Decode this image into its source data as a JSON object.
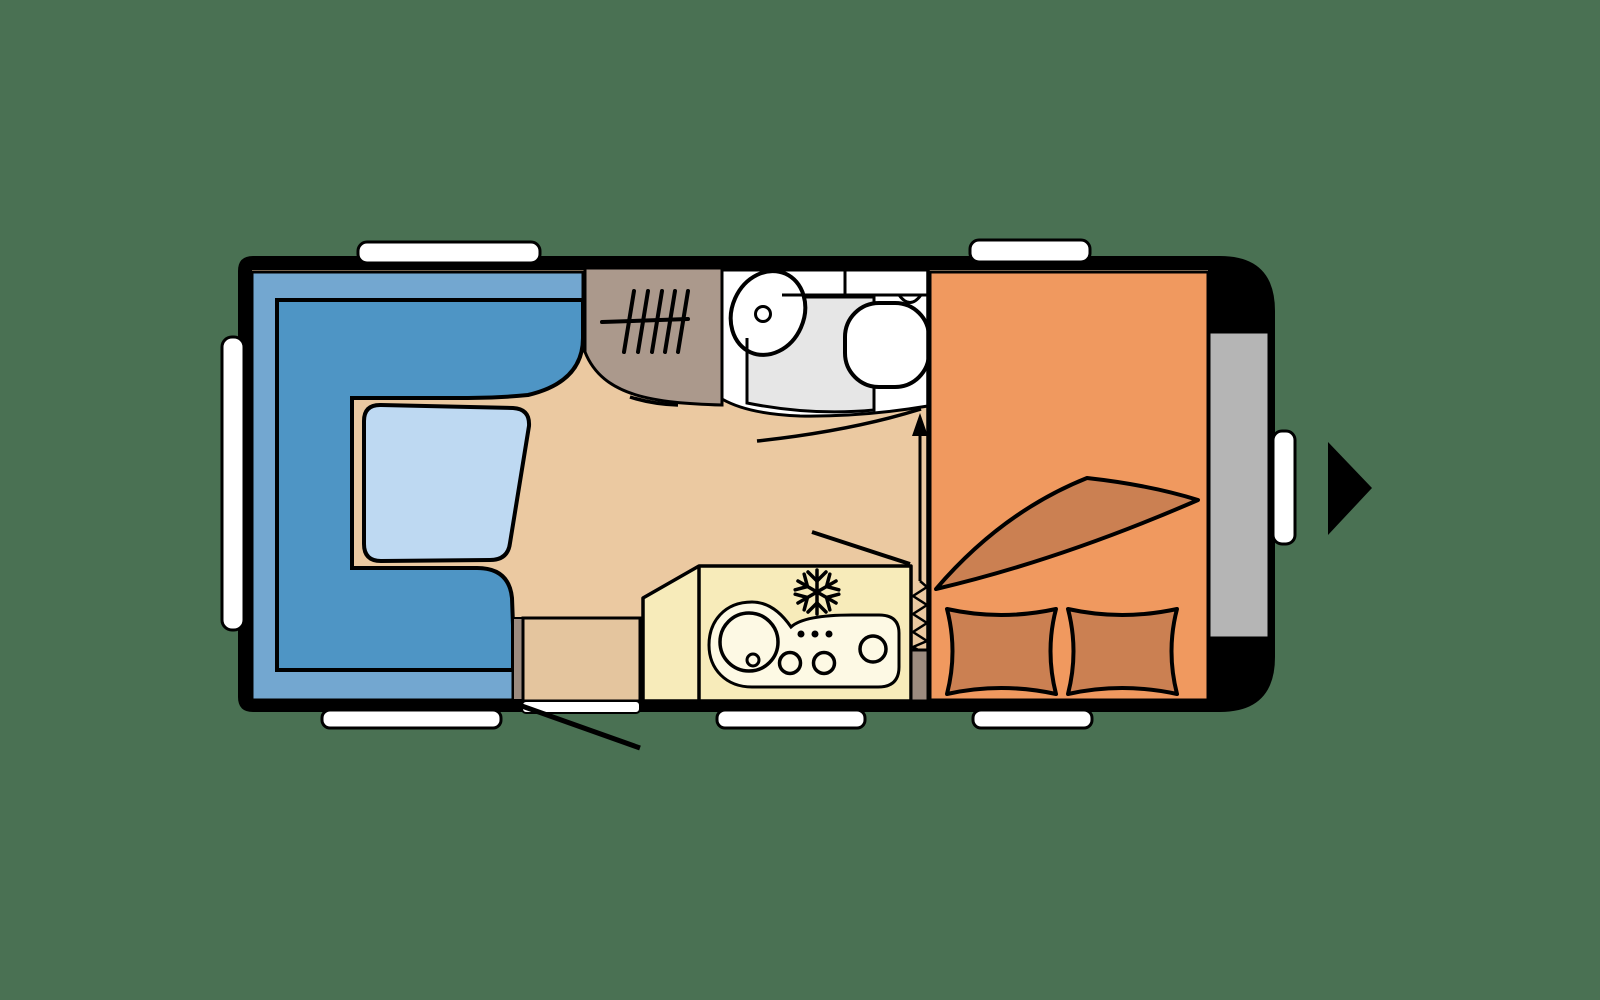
{
  "title": "caravan-floorplan-top-view",
  "colors": {
    "background": "#4a7153",
    "body": "#000000",
    "floor": "#ebc9a1",
    "window": "#ffffff",
    "seat_back": "#73a7d0",
    "seat": "#4e95c5",
    "table": "#bed9f2",
    "wardrobe": "#ab998c",
    "bathroom": "#ffffff",
    "shower": "#e6e6e6",
    "fixture": "#ffffff",
    "bed": "#f0995f",
    "bedding": "#cb8052",
    "kitchen": "#f7ebba",
    "counter": "#fdf9e4",
    "storage": "#b5b5b5",
    "door_frame": "#9c8b7f",
    "door": "#e4c59e"
  },
  "icons": {
    "wardrobe_rail": "hanger-rail-hatch",
    "fridge": "snowflake",
    "partition": "zigzag-concertina",
    "door_swing": "diagonal-line",
    "travel_direction": "right-triangle-arrow"
  }
}
